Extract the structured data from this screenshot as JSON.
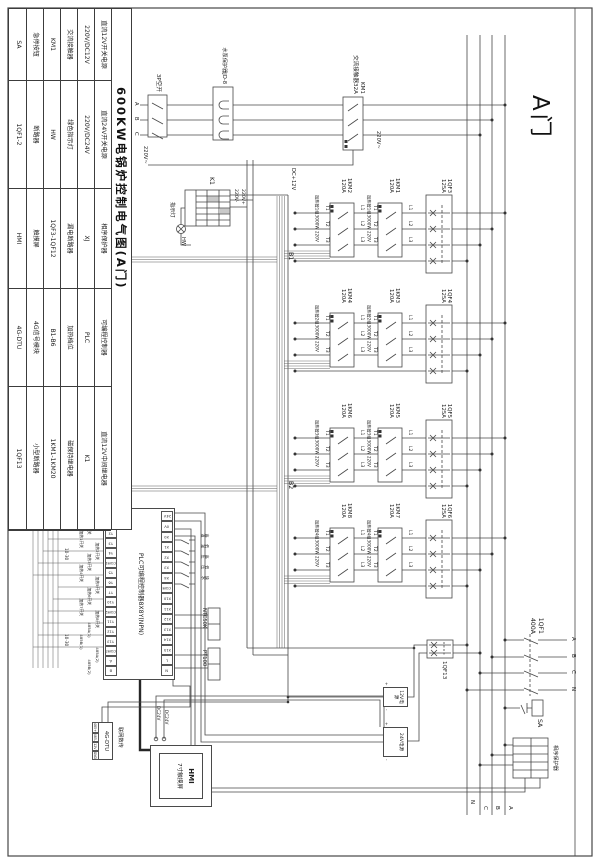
{
  "door_label": "A门",
  "title_block": {
    "title": "600KW电锅炉控制电气图(A门)",
    "cells": [
      "直流12V开关电源",
      "直流24V开关电源",
      "相序保护器",
      "可编程控制器",
      "直流12V中间继电器",
      "220V/DC12V",
      "220V/DC24V",
      "XJ",
      "PLC",
      "K1",
      "交流接触器",
      "绿色指示灯",
      "漏电断路器",
      "加热档位",
      "磁保持继电器",
      "KM1",
      "HW",
      "1QF3-1QF12",
      "B1-B6",
      "1KM1-1KM20",
      "急停按钮",
      "断路器",
      "触摸屏",
      "4G信号模块",
      "小型断路器",
      "SA",
      "1QF1-2",
      "HMI",
      "4G-DTU",
      "1QF13"
    ]
  },
  "mains": {
    "incoming": [
      "A",
      "B",
      "C",
      "N"
    ],
    "bus": [
      "A",
      "B",
      "C",
      "N"
    ],
    "qf1": "1QF1",
    "qf1_rating": "400A",
    "sa": "SA",
    "xj_name": "相序保护器"
  },
  "pump": {
    "km1": "KM1",
    "km1_type": "交流接触器32A",
    "jd8": "水泵保护器JD-8",
    "sw3p": "3P空开",
    "phases": [
      "A",
      "B",
      "C"
    ],
    "v220a": "220V~",
    "v220b": "220V~"
  },
  "k1zone": {
    "k1": "K1",
    "vplus": "220V+",
    "vminus": "220V-",
    "lamp": "指示灯",
    "hw": "HW",
    "dc12": "DC+12V"
  },
  "terms": {
    "t": [
      "T1",
      "T2",
      "T3"
    ],
    "l": [
      "L1",
      "L2",
      "L3"
    ]
  },
  "chains": [
    {
      "qf": "1QF3",
      "qf_a": "125A",
      "km1": "1KM1",
      "km1_a": "120A",
      "km2": "1KM2",
      "km2_a": "120A",
      "heat": "加热管1组3000W 220V"
    },
    {
      "qf": "1QF4",
      "qf_a": "125A",
      "km1": "1KM3",
      "km1_a": "120A",
      "km2": "1KM4",
      "km2_a": "120A",
      "heat": "加热管2组3000W 220V"
    },
    {
      "qf": "1QF5",
      "qf_a": "125A",
      "km1": "1KM5",
      "km1_a": "120A",
      "km2": "1KM6",
      "km2_a": "120A",
      "heat": "加热管3组3000W 220V"
    },
    {
      "qf": "1QF6",
      "qf_a": "125A",
      "km1": "1KM7",
      "km1_a": "120A",
      "km2": "1KM8",
      "km2_a": "120A",
      "heat": "加热管4组3000W 220V"
    }
  ],
  "bundles": {
    "b1": "B1",
    "b2": "B2",
    "tag": "10-30"
  },
  "power": {
    "qf13": "1QF13",
    "psu12": "12V电源",
    "psu24": "24V电源",
    "plus": "+",
    "minus": "-"
  },
  "plc": {
    "name": "PLC可编程控制器8X8Y(NPN)",
    "top_terms": [
      "24V",
      "0V",
      "X0",
      "X1",
      "X2",
      "X3",
      "X4",
      "COM",
      "X10",
      "X11",
      "X12",
      "X13",
      "X14",
      "X15",
      "L",
      "N"
    ],
    "bot_terms": [
      "Y0",
      "Y1",
      "Y2",
      "Y3",
      "Y4",
      "COM1",
      "Y5",
      "Y6",
      "Y7",
      "Y10",
      "COM2",
      "Y11",
      "Y12",
      "Y13",
      "COM3",
      "A",
      "B"
    ],
    "out_labels": [
      "水泵开关",
      "指示开关",
      "加热1开关",
      "加热2开关",
      "加热3开关",
      "加热4开关",
      "加热5开关",
      "加热6开关",
      "加热7开关",
      "加热8开关",
      "485A(1)",
      "485B(1)",
      "485A(2)",
      "485B(2)"
    ],
    "in_labels": [
      "高温",
      "低温",
      "高压",
      "低压",
      "缺水"
    ]
  },
  "sensors": {
    "ntc": "NTC50K",
    "pt": "PT100"
  },
  "hmi": {
    "name": "HMI",
    "type": "7寸触摸屏",
    "pwr": [
      "DC24V",
      "DC24V"
    ]
  },
  "dtu": {
    "name": "4G-DTU",
    "note": "联网数传",
    "pins": [
      "485+",
      "485-",
      "12V",
      "GND"
    ]
  }
}
